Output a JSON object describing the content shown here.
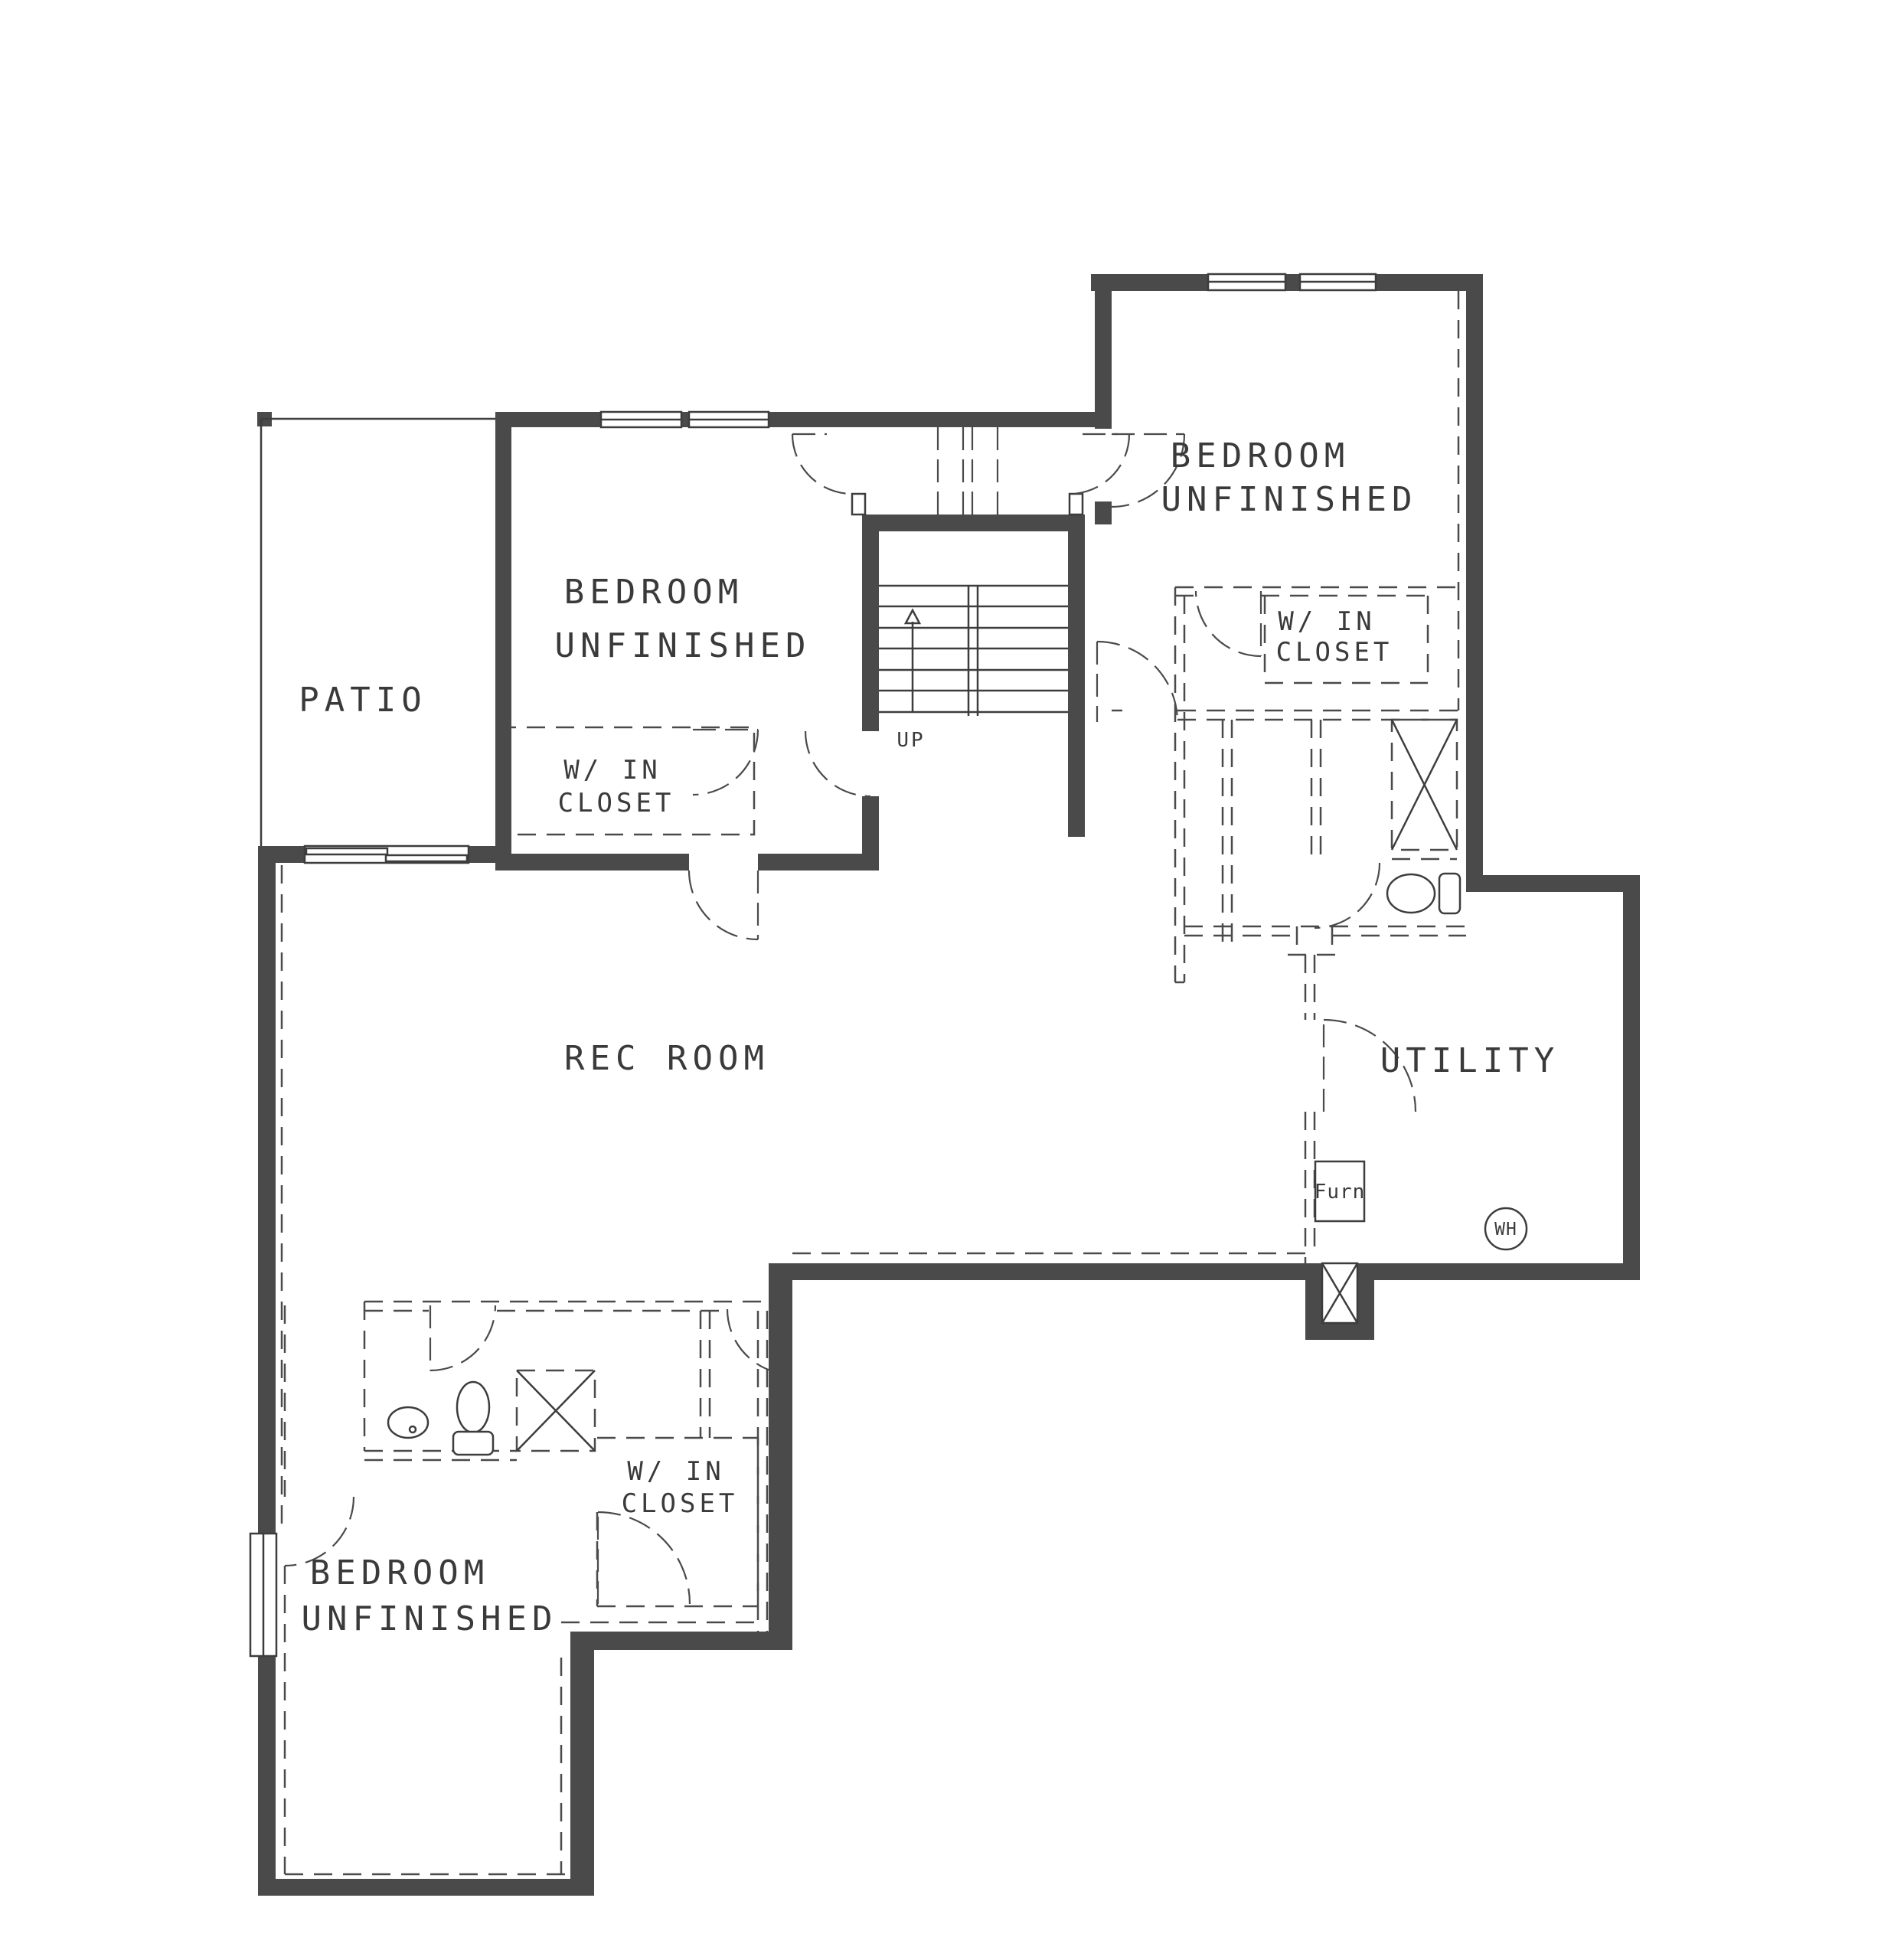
{
  "drawing": {
    "type": "basement floor plan",
    "colors": {
      "wall": "#4a4a4a",
      "line": "#3d3d3d",
      "text": "#3a3a3a",
      "background": "#ffffff"
    }
  },
  "rooms": {
    "patio": {
      "label": "PATIO"
    },
    "bedroom_nw": {
      "line1": "BEDROOM",
      "line2": "UNFINISHED"
    },
    "bedroom_ne": {
      "line1": "BEDROOM",
      "line2": "UNFINISHED"
    },
    "bedroom_s": {
      "line1": "BEDROOM",
      "line2": "UNFINISHED"
    },
    "closet_nw": {
      "line1": "W/ IN",
      "line2": "CLOSET"
    },
    "closet_ne": {
      "line1": "W/ IN",
      "line2": "CLOSET"
    },
    "closet_s": {
      "line1": "W/ IN",
      "line2": "CLOSET"
    },
    "rec_room": {
      "label": "REC ROOM"
    },
    "utility": {
      "label": "UTILITY"
    }
  },
  "stairs": {
    "direction_label": "UP"
  },
  "equipment": {
    "furnace": "Furn",
    "water_heater": "WH"
  }
}
